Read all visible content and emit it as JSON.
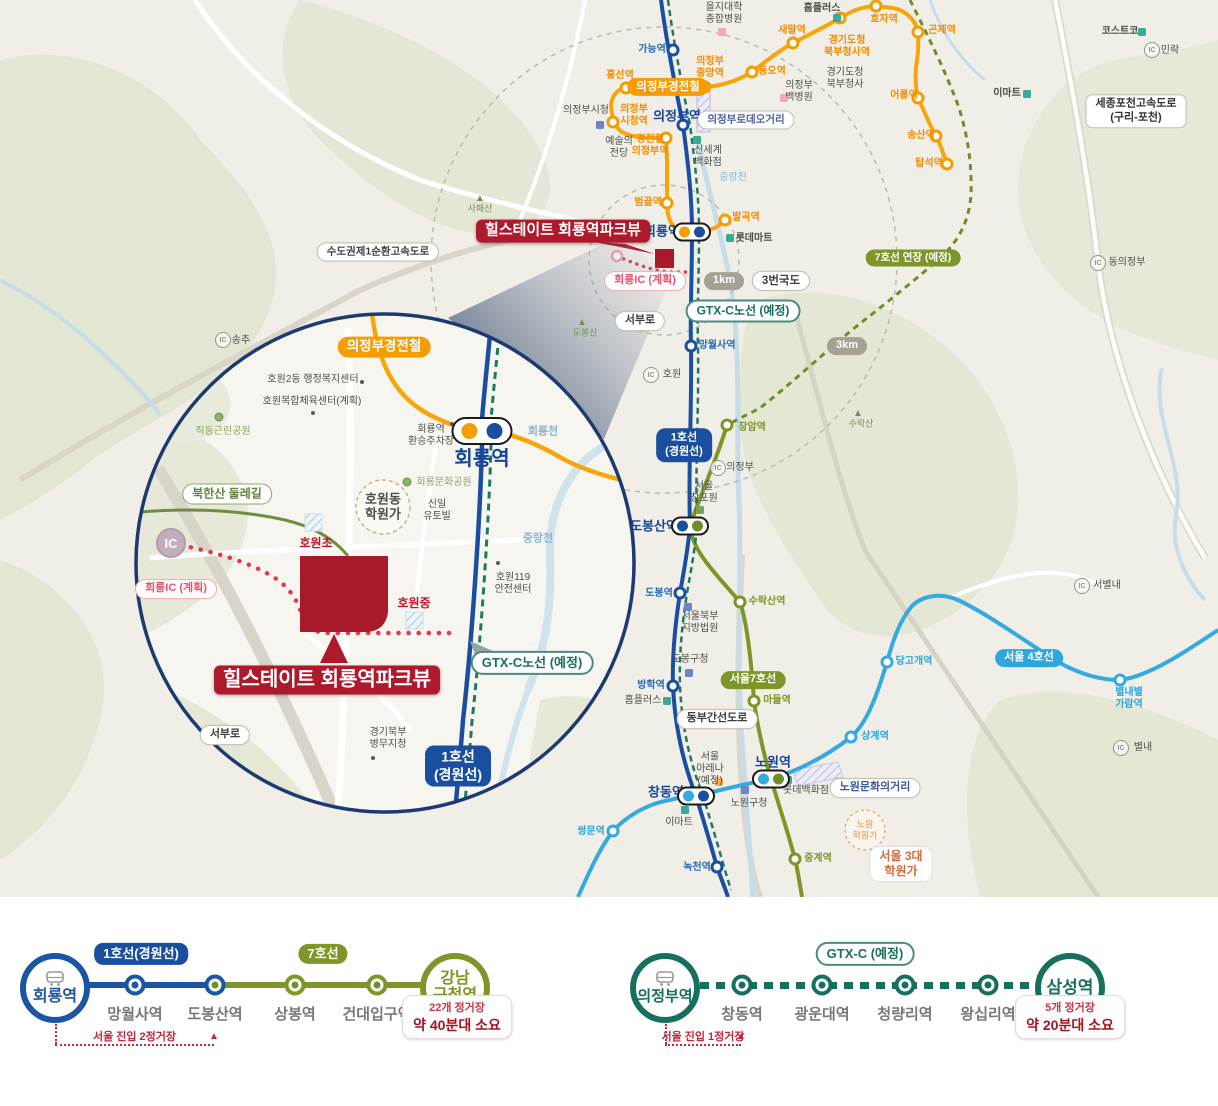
{
  "colors": {
    "line1_blue": "#1a4f9f",
    "gtx_teal": "#17705d",
    "lrt_orange": "#f59c00",
    "line7_olive": "#7d9627",
    "line4_cyan": "#35aade",
    "brand_red": "#ae1a2b",
    "plan_pink": "#e8556b",
    "badge_gray": "#a5a193"
  },
  "map": {
    "labels": [
      {
        "t": "을지대학\n종합병원",
        "x": 724,
        "y": 14,
        "c": "gy"
      },
      {
        "t": "홈플러스",
        "x": 822,
        "y": 9,
        "c": "gy",
        "b": 1
      },
      {
        "t": "효자역",
        "x": 884,
        "y": 20,
        "c": "or",
        "b": 1
      },
      {
        "t": "곤제역",
        "x": 942,
        "y": 31,
        "c": "or",
        "b": 1
      },
      {
        "t": "코스트코",
        "x": 1120,
        "y": 32,
        "c": "gy",
        "b": 1
      },
      {
        "t": "민락",
        "x": 1170,
        "y": 51,
        "c": "gy"
      },
      {
        "t": "가능역",
        "x": 652,
        "y": 50,
        "c": "bl",
        "b": 1
      },
      {
        "t": "새말역",
        "x": 792,
        "y": 31,
        "c": "or",
        "b": 1
      },
      {
        "t": "경기도청\n북부청사역",
        "x": 847,
        "y": 47,
        "c": "or",
        "b": 1
      },
      {
        "t": "의정부\n중앙역",
        "x": 710,
        "y": 68,
        "c": "or",
        "b": 1
      },
      {
        "t": "동오역",
        "x": 772,
        "y": 72,
        "c": "or",
        "b": 1
      },
      {
        "t": "흥선역",
        "x": 620,
        "y": 76,
        "c": "or",
        "b": 1
      },
      {
        "t": "경기도청\n북부청사",
        "x": 845,
        "y": 79,
        "c": "gy"
      },
      {
        "t": "의정부\n백병원",
        "x": 799,
        "y": 92,
        "c": "gy"
      },
      {
        "t": "어룡역",
        "x": 904,
        "y": 96,
        "c": "or",
        "b": 1
      },
      {
        "t": "이마트",
        "x": 1007,
        "y": 94,
        "c": "gy",
        "b": 1
      },
      {
        "t": "의정부시청",
        "x": 586,
        "y": 111,
        "c": "gy"
      },
      {
        "t": "의정부\n시청역",
        "x": 634,
        "y": 116,
        "c": "or",
        "b": 1
      },
      {
        "t": "의정부역",
        "x": 677,
        "y": 116,
        "c": "nv",
        "b": 1,
        "fs": 13
      },
      {
        "t": "예술의\n전당",
        "x": 619,
        "y": 148,
        "c": "gy"
      },
      {
        "t": "경전철\n의정부역",
        "x": 650,
        "y": 146,
        "c": "or",
        "b": 1
      },
      {
        "t": "신세계\n백화점",
        "x": 708,
        "y": 157,
        "c": "gy"
      },
      {
        "t": "송산역",
        "x": 921,
        "y": 136,
        "c": "or",
        "b": 1
      },
      {
        "t": "탑석역",
        "x": 929,
        "y": 164,
        "c": "or",
        "b": 1
      },
      {
        "t": "중랑천",
        "x": 733,
        "y": 178,
        "c": "wa"
      },
      {
        "t": "범골역",
        "x": 648,
        "y": 203,
        "c": "or",
        "b": 1
      },
      {
        "t": "발곡역",
        "x": 746,
        "y": 218,
        "c": "or",
        "b": 1
      },
      {
        "t": "사패산",
        "x": 480,
        "y": 209,
        "c": "mt",
        "fs": 9
      },
      {
        "t": "회룡역",
        "x": 662,
        "y": 231,
        "c": "nv",
        "b": 1,
        "fs": 13
      },
      {
        "t": "롯데마트",
        "x": 754,
        "y": 239,
        "c": "gy",
        "b": 1
      },
      {
        "t": "동의정부",
        "x": 1127,
        "y": 263,
        "c": "gy"
      },
      {
        "t": "도봉산",
        "x": 585,
        "y": 333,
        "c": "mt",
        "fs": 9
      },
      {
        "t": "호원",
        "x": 672,
        "y": 375,
        "c": "gy"
      },
      {
        "t": "망월사역",
        "x": 717,
        "y": 346,
        "c": "bl",
        "b": 1
      },
      {
        "t": "수락산",
        "x": 861,
        "y": 424,
        "c": "mt",
        "fs": 9
      },
      {
        "t": "장암역",
        "x": 752,
        "y": 428,
        "c": "ol",
        "b": 1
      },
      {
        "t": "의정부",
        "x": 740,
        "y": 468,
        "c": "gy"
      },
      {
        "t": "서울\n창포원",
        "x": 704,
        "y": 493,
        "c": "gy"
      },
      {
        "t": "도봉산역",
        "x": 654,
        "y": 526,
        "c": "nv",
        "b": 1,
        "fs": 13
      },
      {
        "t": "서별내",
        "x": 1107,
        "y": 586,
        "c": "gy"
      },
      {
        "t": "도봉역",
        "x": 659,
        "y": 594,
        "c": "bl",
        "b": 1
      },
      {
        "t": "수락산역",
        "x": 767,
        "y": 602,
        "c": "ol",
        "b": 1
      },
      {
        "t": "서울북부\n지방법원",
        "x": 700,
        "y": 623,
        "c": "gy"
      },
      {
        "t": "당고개역",
        "x": 914,
        "y": 662,
        "c": "cy",
        "b": 1
      },
      {
        "t": "도봉구청",
        "x": 690,
        "y": 660,
        "c": "gy"
      },
      {
        "t": "방학역",
        "x": 651,
        "y": 686,
        "c": "bl",
        "b": 1
      },
      {
        "t": "별내별\n가람역",
        "x": 1129,
        "y": 699,
        "c": "cy",
        "b": 1
      },
      {
        "t": "홈플러스",
        "x": 643,
        "y": 701,
        "c": "gy"
      },
      {
        "t": "마들역",
        "x": 777,
        "y": 701,
        "c": "ol",
        "b": 1
      },
      {
        "t": "상계역",
        "x": 875,
        "y": 737,
        "c": "cy",
        "b": 1
      },
      {
        "t": "별내",
        "x": 1143,
        "y": 748,
        "c": "gy"
      },
      {
        "t": "서울\n아레나\n(예정)",
        "x": 710,
        "y": 769,
        "c": "gy"
      },
      {
        "t": "노원역",
        "x": 773,
        "y": 762,
        "c": "nv",
        "b": 1,
        "fs": 13
      },
      {
        "t": "롯데백화점",
        "x": 806,
        "y": 791,
        "c": "gy"
      },
      {
        "t": "창동역",
        "x": 666,
        "y": 792,
        "c": "nv",
        "b": 1,
        "fs": 13
      },
      {
        "t": "노원구청",
        "x": 749,
        "y": 804,
        "c": "gy"
      },
      {
        "t": "이마트",
        "x": 679,
        "y": 823,
        "c": "gy"
      },
      {
        "t": "쌍문역",
        "x": 591,
        "y": 832,
        "c": "cy",
        "b": 1
      },
      {
        "t": "중계역",
        "x": 818,
        "y": 859,
        "c": "ol",
        "b": 1
      },
      {
        "t": "녹천역",
        "x": 697,
        "y": 868,
        "c": "bl",
        "b": 1
      },
      {
        "t": "노원\n학원가",
        "x": 865,
        "y": 830,
        "c": "or2",
        "fs": 9
      },
      {
        "t": "송추",
        "x": 241,
        "y": 341,
        "c": "gy"
      },
      {
        "t": "호원2동 행정복지센터",
        "x": 313,
        "y": 380,
        "c": "gy"
      },
      {
        "t": "호원복합체육센터(계획)",
        "x": 312,
        "y": 402,
        "c": "gy"
      },
      {
        "t": "직동근린공원",
        "x": 223,
        "y": 432,
        "c": "gn"
      },
      {
        "t": "회룡역\n환승주차장",
        "x": 431,
        "y": 436,
        "c": "gy"
      },
      {
        "t": "회룡천",
        "x": 543,
        "y": 432,
        "c": "wa",
        "b": 1,
        "fs": 11
      },
      {
        "t": "회룡역",
        "x": 482,
        "y": 460,
        "c": "nv",
        "b": 1,
        "fs": 20
      },
      {
        "t": "회룡문화공원",
        "x": 444,
        "y": 483,
        "c": "gn"
      },
      {
        "t": "호원동\n학원가",
        "x": 383,
        "y": 507,
        "c": "gy",
        "b": 1,
        "fs": 13
      },
      {
        "t": "신일\n유토빌",
        "x": 437,
        "y": 511,
        "c": "gy"
      },
      {
        "t": "호원초",
        "x": 316,
        "y": 543,
        "c": "rd",
        "b": 1,
        "fs": 12
      },
      {
        "t": "중랑천",
        "x": 538,
        "y": 539,
        "c": "wa",
        "b": 1,
        "fs": 11
      },
      {
        "t": "호원119\n안전센터",
        "x": 513,
        "y": 584,
        "c": "gy"
      },
      {
        "t": "호원중",
        "x": 414,
        "y": 603,
        "c": "rd",
        "b": 1,
        "fs": 12
      },
      {
        "t": "경기북부\n병무지청",
        "x": 388,
        "y": 739,
        "c": "gy"
      },
      {
        "t": "IC",
        "x": 171,
        "y": 543,
        "c": "icbig"
      }
    ],
    "badges": [
      {
        "t": "의정부경전철",
        "x": 668,
        "y": 87,
        "k": "or",
        "fs": 11.5
      },
      {
        "t": "의정부로데오거리",
        "x": 746,
        "y": 120,
        "k": "wh",
        "fs": 10.5,
        "tc": "#4a5f9e"
      },
      {
        "t": "수도권제1순환고속도로",
        "x": 378,
        "y": 252,
        "k": "wh",
        "fs": 10.5
      },
      {
        "t": "세종포천고속도로\n(구리-포천)",
        "x": 1136,
        "y": 111,
        "k": "wh2",
        "fs": 11
      },
      {
        "t": "힐스테이트 회룡역파크뷰",
        "x": 563,
        "y": 231,
        "k": "rd",
        "fs": 15,
        "ptr": "br"
      },
      {
        "t": "회룡IC (계획)",
        "x": 645,
        "y": 281,
        "k": "pk",
        "fs": 11
      },
      {
        "t": "1km",
        "x": 724,
        "y": 281,
        "k": "gy",
        "fs": 11
      },
      {
        "t": "3번국도",
        "x": 781,
        "y": 281,
        "k": "wh",
        "fs": 11.5
      },
      {
        "t": "GTX-C노선 (예정)",
        "x": 743,
        "y": 311,
        "k": "te",
        "fs": 12
      },
      {
        "t": "7호선 연장 (예정)",
        "x": 913,
        "y": 258,
        "k": "ol",
        "fs": 10.5
      },
      {
        "t": "3km",
        "x": 847,
        "y": 346,
        "k": "gy",
        "fs": 11
      },
      {
        "t": "서부로",
        "x": 640,
        "y": 321,
        "k": "wh",
        "fs": 11
      },
      {
        "t": "1호선\n(경원선)",
        "x": 684,
        "y": 445,
        "k": "bl",
        "fs": 11
      },
      {
        "t": "서울7호선",
        "x": 753,
        "y": 680,
        "k": "ol",
        "fs": 11
      },
      {
        "t": "서울 4호선",
        "x": 1029,
        "y": 658,
        "k": "cy",
        "fs": 11
      },
      {
        "t": "동부간선도로",
        "x": 717,
        "y": 719,
        "k": "wh",
        "fs": 11
      },
      {
        "t": "노원문화의거리",
        "x": 875,
        "y": 788,
        "k": "wh",
        "fs": 11,
        "tc": "#3a5aa0"
      },
      {
        "t": "서울 3대\n학원가",
        "x": 901,
        "y": 864,
        "k": "whrd",
        "fs": 12
      },
      {
        "t": "의정부경전철",
        "x": 384,
        "y": 347,
        "k": "or",
        "fs": 13.5
      },
      {
        "t": "북한산 둘레길",
        "x": 227,
        "y": 494,
        "k": "gn",
        "fs": 12
      },
      {
        "t": "회룡IC (계획)",
        "x": 176,
        "y": 589,
        "k": "pk",
        "fs": 11
      },
      {
        "t": "GTX-C노선 (예정)",
        "x": 532,
        "y": 663,
        "k": "te",
        "fs": 13
      },
      {
        "t": "힐스테이트 회룡역파크뷰",
        "x": 327,
        "y": 680,
        "k": "rd",
        "fs": 20,
        "ptr": "t"
      },
      {
        "t": "서부로",
        "x": 225,
        "y": 735,
        "k": "wh",
        "fs": 11
      },
      {
        "t": "1호선\n(경원선)",
        "x": 458,
        "y": 766,
        "k": "bl",
        "fs": 14
      }
    ],
    "stations": [
      {
        "x": 673,
        "y": 50,
        "c": "nv"
      },
      {
        "x": 683,
        "y": 125,
        "c": "nv"
      },
      {
        "x": 691,
        "y": 346,
        "c": "nv"
      },
      {
        "x": 680,
        "y": 593,
        "c": "nv"
      },
      {
        "x": 673,
        "y": 686,
        "c": "nv"
      },
      {
        "x": 717,
        "y": 867,
        "c": "nv"
      },
      {
        "x": 626,
        "y": 88,
        "c": "or"
      },
      {
        "x": 705,
        "y": 87,
        "c": "or"
      },
      {
        "x": 752,
        "y": 72,
        "c": "or"
      },
      {
        "x": 793,
        "y": 43,
        "c": "or"
      },
      {
        "x": 840,
        "y": 18,
        "c": "or"
      },
      {
        "x": 876,
        "y": 6,
        "c": "or"
      },
      {
        "x": 918,
        "y": 32,
        "c": "or"
      },
      {
        "x": 918,
        "y": 98,
        "c": "or"
      },
      {
        "x": 936,
        "y": 136,
        "c": "or"
      },
      {
        "x": 947,
        "y": 164,
        "c": "or"
      },
      {
        "x": 613,
        "y": 122,
        "c": "or"
      },
      {
        "x": 666,
        "y": 138,
        "c": "or"
      },
      {
        "x": 667,
        "y": 203,
        "c": "or"
      },
      {
        "x": 725,
        "y": 220,
        "c": "or"
      },
      {
        "x": 727,
        "y": 425,
        "c": "ol"
      },
      {
        "x": 740,
        "y": 602,
        "c": "ol"
      },
      {
        "x": 754,
        "y": 701,
        "c": "ol"
      },
      {
        "x": 795,
        "y": 859,
        "c": "ol"
      },
      {
        "x": 613,
        "y": 831,
        "c": "cy"
      },
      {
        "x": 851,
        "y": 737,
        "c": "cy"
      },
      {
        "x": 887,
        "y": 662,
        "c": "cy"
      },
      {
        "x": 1120,
        "y": 680,
        "c": "cy"
      }
    ],
    "pill_stations": [
      {
        "x": 692,
        "y": 232,
        "d": [
          "or",
          "nv"
        ]
      },
      {
        "x": 690,
        "y": 526,
        "d": [
          "nv",
          "ol"
        ]
      },
      {
        "x": 771,
        "y": 779,
        "d": [
          "cy",
          "ol"
        ]
      },
      {
        "x": 696,
        "y": 796,
        "d": [
          "cy",
          "nv"
        ]
      },
      {
        "x": 482,
        "y": 431,
        "d": [
          "or",
          "nv"
        ],
        "big": 1
      }
    ],
    "ics": [
      {
        "x": 223,
        "y": 340
      },
      {
        "x": 651,
        "y": 375
      },
      {
        "x": 718,
        "y": 468
      },
      {
        "x": 1098,
        "y": 263
      },
      {
        "x": 1152,
        "y": 50
      },
      {
        "x": 1082,
        "y": 586
      },
      {
        "x": 1121,
        "y": 748
      }
    ],
    "squares": [
      {
        "x": 837,
        "y": 18,
        "c": "teal"
      },
      {
        "x": 730,
        "y": 238,
        "c": "teal"
      },
      {
        "x": 697,
        "y": 140,
        "c": "teal"
      },
      {
        "x": 1027,
        "y": 94,
        "c": "teal"
      },
      {
        "x": 1142,
        "y": 32,
        "c": "teal"
      },
      {
        "x": 667,
        "y": 701,
        "c": "teal"
      },
      {
        "x": 788,
        "y": 780,
        "c": "teal"
      },
      {
        "x": 685,
        "y": 810,
        "c": "teal"
      },
      {
        "x": 600,
        "y": 125,
        "c": "blue"
      },
      {
        "x": 688,
        "y": 607,
        "c": "blue"
      },
      {
        "x": 689,
        "y": 673,
        "c": "blue"
      },
      {
        "x": 745,
        "y": 790,
        "c": "blue"
      },
      {
        "x": 722,
        "y": 32,
        "c": "pink"
      },
      {
        "x": 784,
        "y": 98,
        "c": "pink"
      },
      {
        "x": 700,
        "y": 510,
        "c": "green"
      },
      {
        "x": 719,
        "y": 782,
        "c": "orange"
      }
    ],
    "mountains": [
      {
        "x": 480,
        "y": 199
      },
      {
        "x": 582,
        "y": 323
      },
      {
        "x": 858,
        "y": 414
      }
    ],
    "trees": [
      {
        "x": 219,
        "y": 417
      },
      {
        "x": 407,
        "y": 482
      }
    ],
    "dots": [
      {
        "x": 362,
        "y": 382
      },
      {
        "x": 313,
        "y": 413
      },
      {
        "x": 452,
        "y": 424
      },
      {
        "x": 498,
        "y": 563
      },
      {
        "x": 373,
        "y": 758
      }
    ]
  },
  "bottom": {
    "left": {
      "origin": {
        "label": "회룡역",
        "x": 55,
        "color": "blue",
        "fs": 16
      },
      "terminal": {
        "label": "강남\n구청역",
        "x": 455,
        "color": "olive",
        "fs": 16
      },
      "badges": [
        {
          "label": "1호선(경원선)",
          "x": 141,
          "color": "bl"
        },
        {
          "label": "7호선",
          "x": 323,
          "color": "ol"
        }
      ],
      "segments": [
        {
          "x1": 88,
          "x2": 216,
          "color": "#1a56a3"
        },
        {
          "x1": 216,
          "x2": 422,
          "color": "#7d9627"
        }
      ],
      "stations": [
        {
          "label": "망월사역",
          "x": 135,
          "ring": "#1a56a3",
          "inner": "#1a56a3"
        },
        {
          "label": "도봉산역",
          "x": 215,
          "ring": "#1a56a3",
          "inner": "#6f8d2a"
        },
        {
          "label": "상봉역",
          "x": 295,
          "ring": "#7d9627",
          "inner": "#6f8d2a"
        },
        {
          "label": "건대입구역",
          "x": 377,
          "ring": "#7d9627",
          "inner": "#6f8d2a"
        }
      ],
      "note": {
        "line1": "22개 정거장",
        "line2": "약 40분대 소요",
        "x": 457
      },
      "entry": {
        "label": "서울 진입 2정거장",
        "x1": 55,
        "x2": 214
      }
    },
    "right": {
      "origin": {
        "label": "의정부역",
        "x": 665,
        "color": "teal",
        "fs": 15
      },
      "terminal": {
        "label": "삼성역",
        "x": 1070,
        "color": "teal",
        "fs": 17
      },
      "badges": [
        {
          "label": "GTX-C (예정)",
          "x": 865,
          "color": "te"
        }
      ],
      "segments": [
        {
          "x1": 700,
          "x2": 1036,
          "color": "#17705d",
          "dashed": true
        }
      ],
      "stations": [
        {
          "label": "창동역",
          "x": 742,
          "ring": "#17705d",
          "inner": "#17705d"
        },
        {
          "label": "광운대역",
          "x": 822,
          "ring": "#17705d",
          "inner": "#17705d"
        },
        {
          "label": "청량리역",
          "x": 905,
          "ring": "#17705d",
          "inner": "#17705d"
        },
        {
          "label": "왕십리역",
          "x": 988,
          "ring": "#17705d",
          "inner": "#17705d"
        }
      ],
      "note": {
        "line1": "5개 정거장",
        "line2": "약 20분대 소요",
        "x": 1070
      },
      "entry": {
        "label": "서울 진입 1정거장",
        "x1": 665,
        "x2": 741
      }
    }
  }
}
